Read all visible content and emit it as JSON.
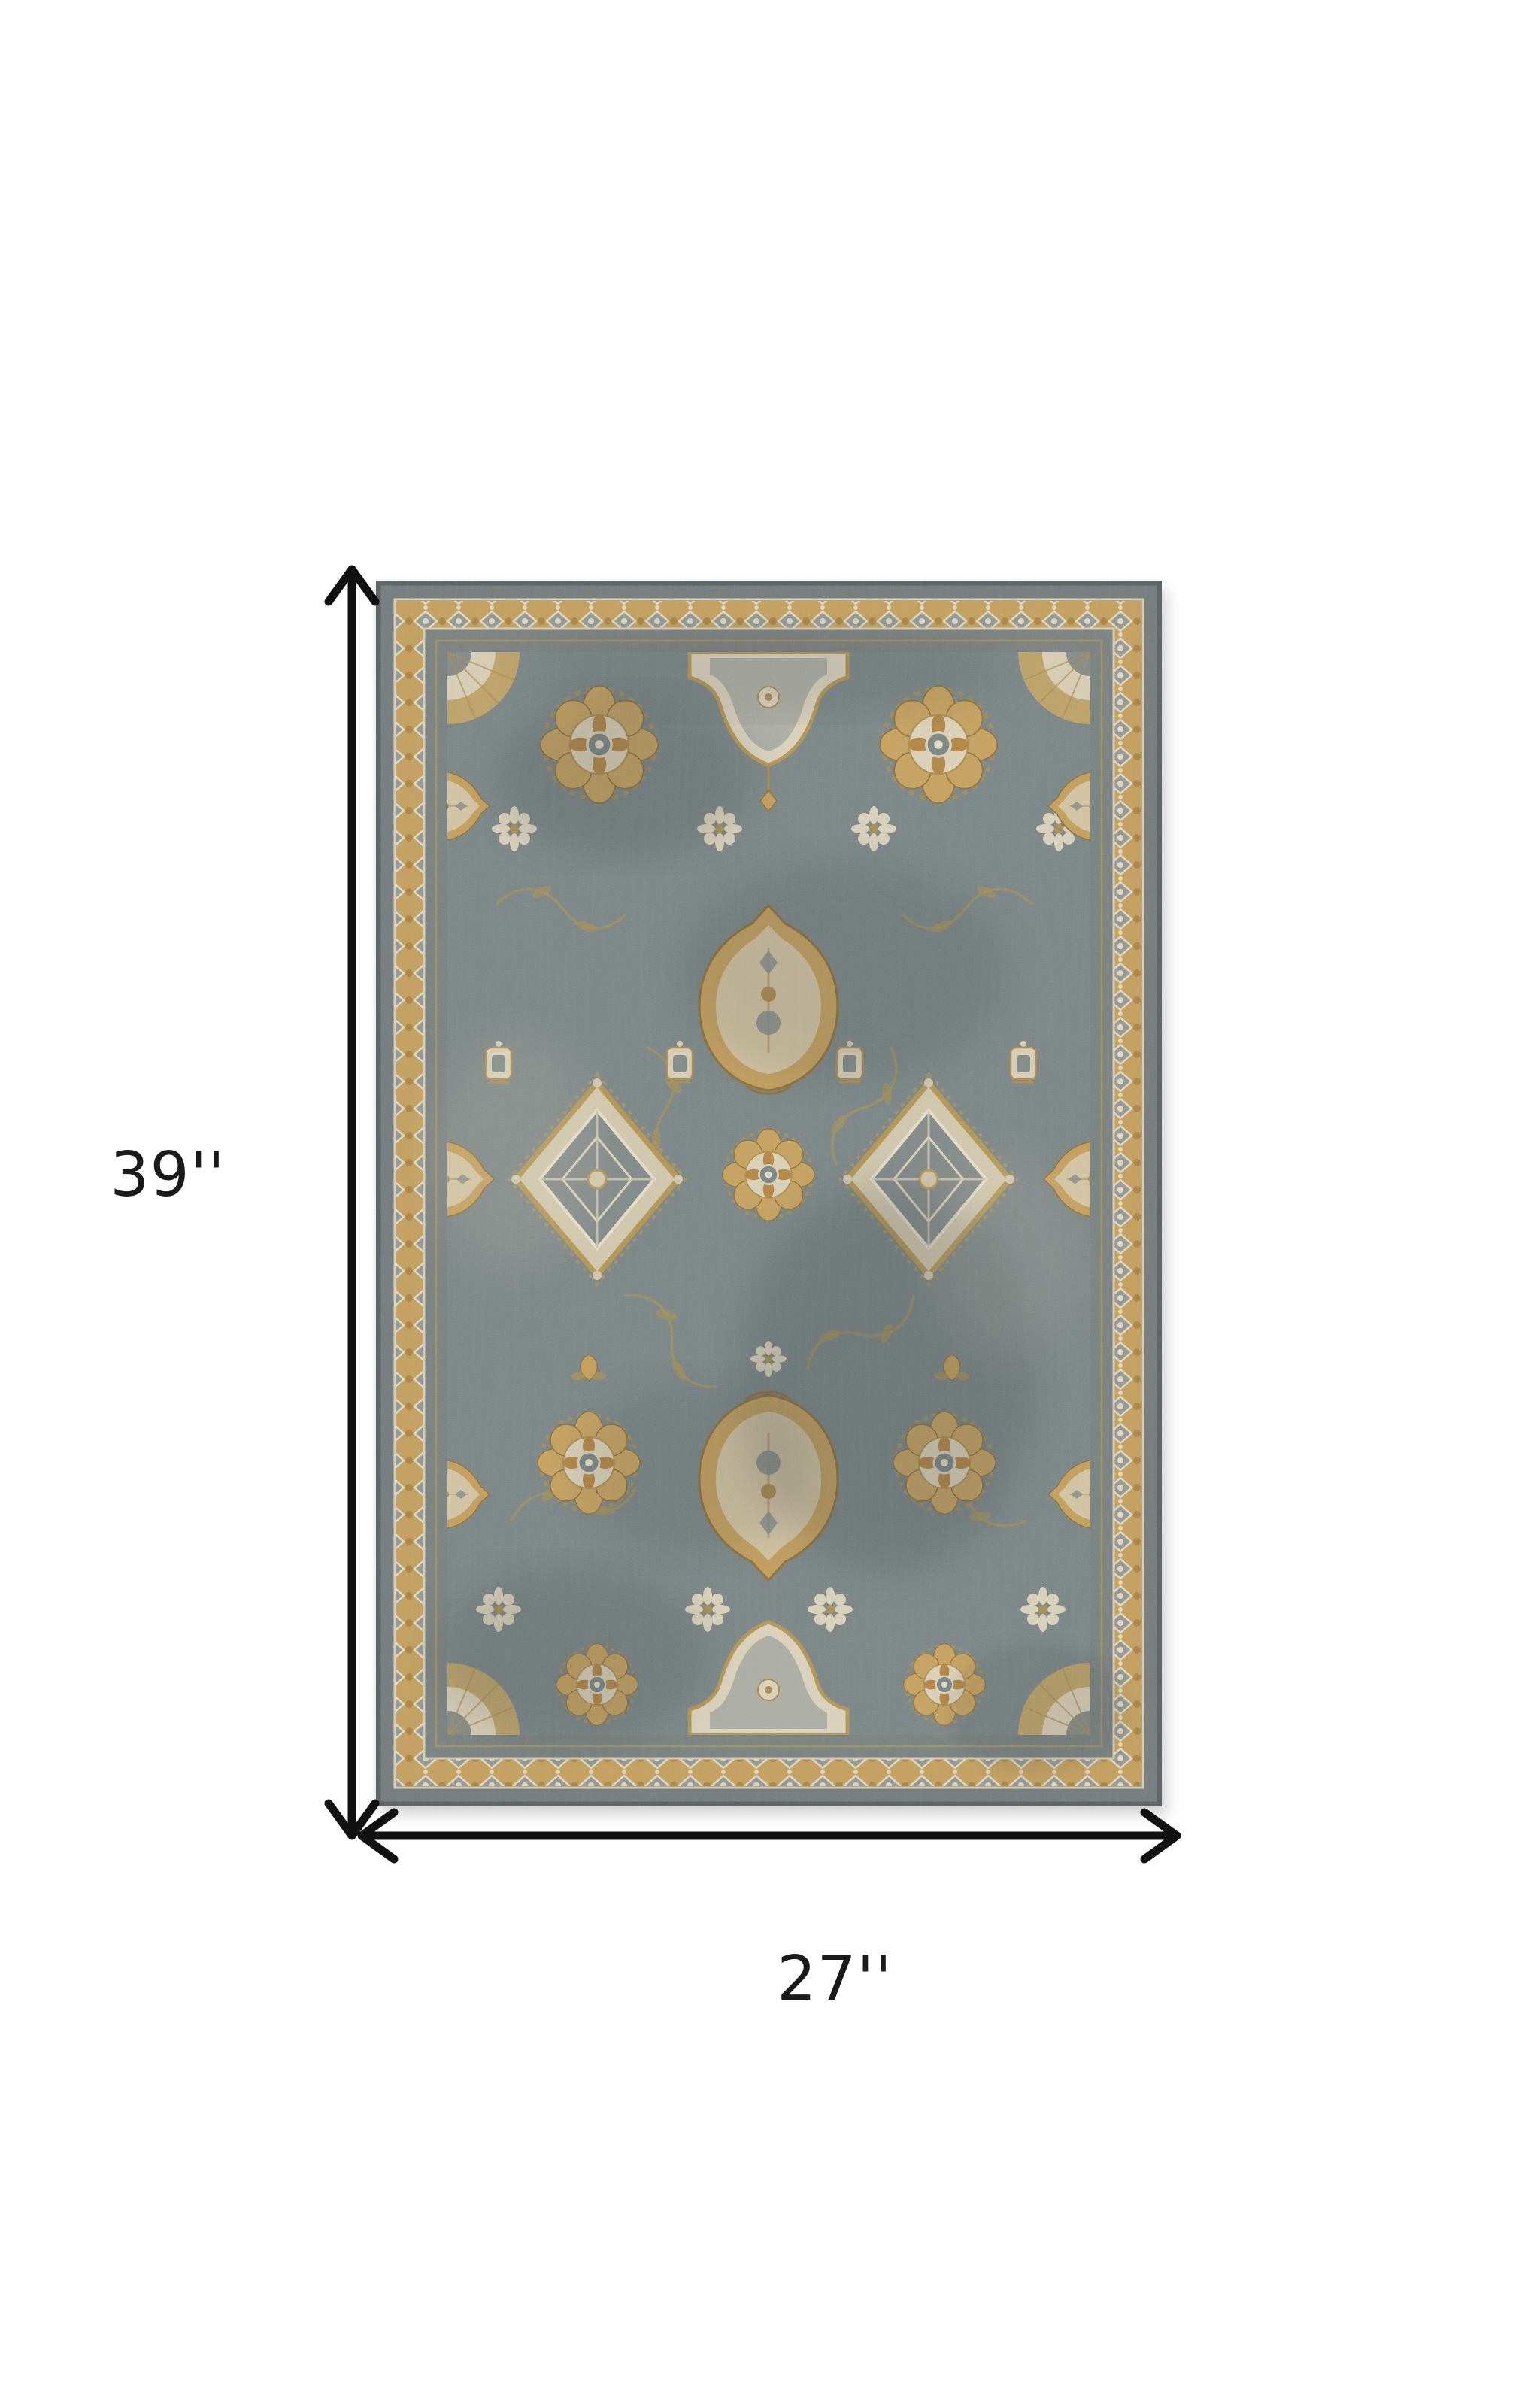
{
  "page": {
    "background": "#ffffff"
  },
  "annotations": {
    "height_label": "39''",
    "width_label": "27''",
    "arrow_color": "#111111",
    "label_color": "#1a1a1a"
  },
  "product": {
    "type": "area-rug",
    "description": "Traditional Persian-style area rug, slate gray field with gold, cream and rust floral medallion pattern and gold rosette border",
    "height_inches": 39,
    "width_inches": 27,
    "colors": {
      "field_gray": "#768080",
      "outer_band_gray": "#6f7677",
      "dark_edge_gray": "#575d5f",
      "border_gold": "#c09b5a",
      "accent_gold": "#c39d5b",
      "cream": "#d9d0b8",
      "rust": "#ad7c3e",
      "vine_gold": "#9d8a55"
    }
  }
}
